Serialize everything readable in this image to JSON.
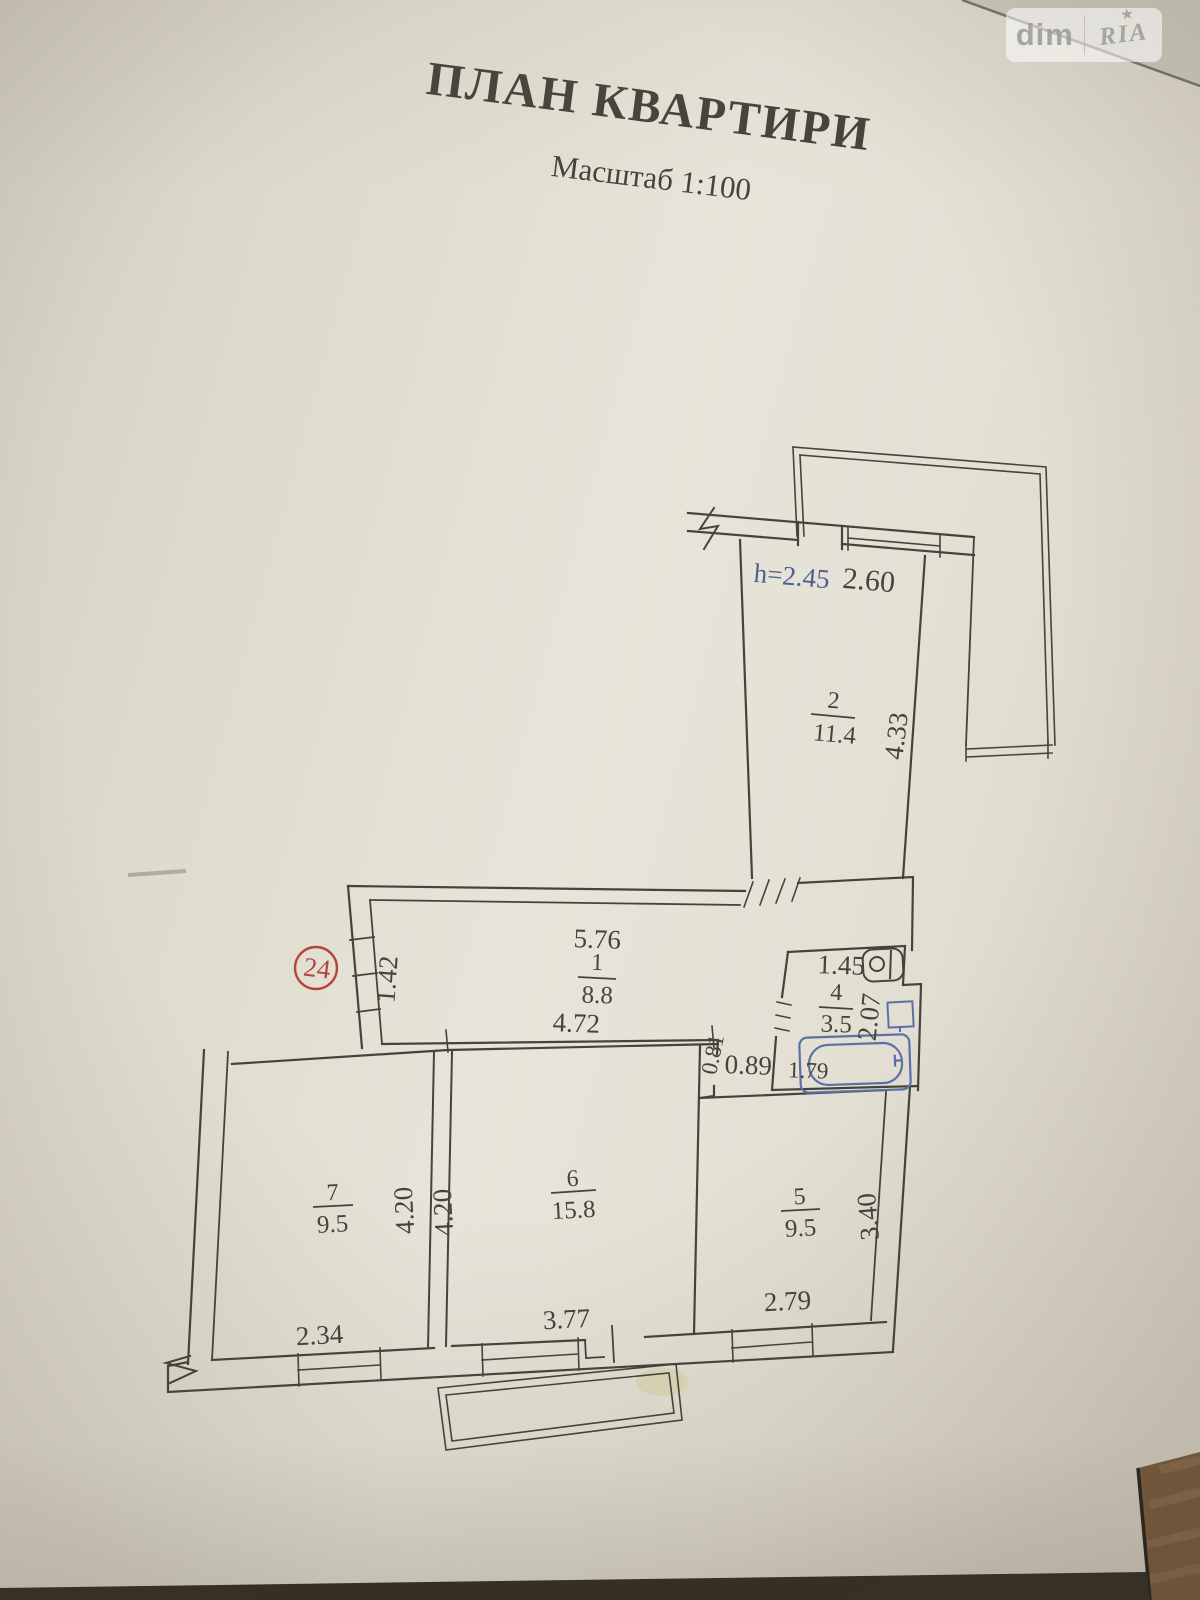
{
  "watermark": {
    "left": "dim",
    "right": "RIA",
    "star": "★"
  },
  "document": {
    "title": "ПЛАН КВАРТИРИ",
    "subtitle": "Масштаб 1:100"
  },
  "plan": {
    "apartment_number": "24",
    "ceiling_height": "h=2.45",
    "rooms": [
      {
        "number": "1",
        "area": "8.8"
      },
      {
        "number": "2",
        "area": "11.4"
      },
      {
        "number": "4",
        "area": "3.5"
      },
      {
        "number": "5",
        "area": "9.5"
      },
      {
        "number": "6",
        "area": "15.8"
      },
      {
        "number": "7",
        "area": "9.5"
      }
    ],
    "dimensions": {
      "room1_top": "5.76",
      "room1_bottom": "4.72",
      "room1_left": "1.42",
      "room2_top": "2.60",
      "room2_right": "4.33",
      "room4_top": "1.45",
      "room4_right": "2.07",
      "room4_bottom": "1.79",
      "lobby_width": "0.89",
      "lobby_depth": "0.81",
      "room5_bottom": "2.79",
      "room5_right": "3.40",
      "room6_bottom": "3.77",
      "room6_left": "4.20",
      "room7_bottom": "2.34",
      "room7_right": "4.20"
    },
    "colors": {
      "ink": "#45443c",
      "blue": "#4d5f94",
      "red": "#b5443c"
    }
  }
}
